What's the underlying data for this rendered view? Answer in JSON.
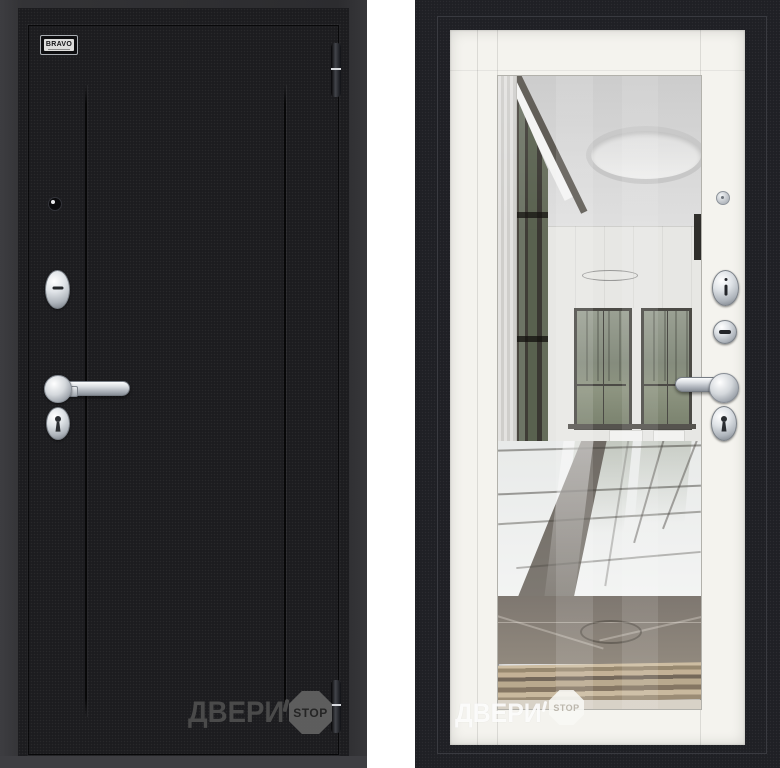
{
  "page": {
    "background": "#ffffff"
  },
  "left_door": {
    "badge_text": "BRAVO",
    "leaf_color": "#1c1c1f",
    "hardware_finish_color": "#c9ccd1"
  },
  "right_door": {
    "frame_color": "#1f2025",
    "panel_color": "#f4f3ee",
    "hardware_finish_color": "#c9ccd1"
  },
  "watermark": {
    "brand_text": "ДВЕРИ",
    "stop_text": "STOP"
  }
}
